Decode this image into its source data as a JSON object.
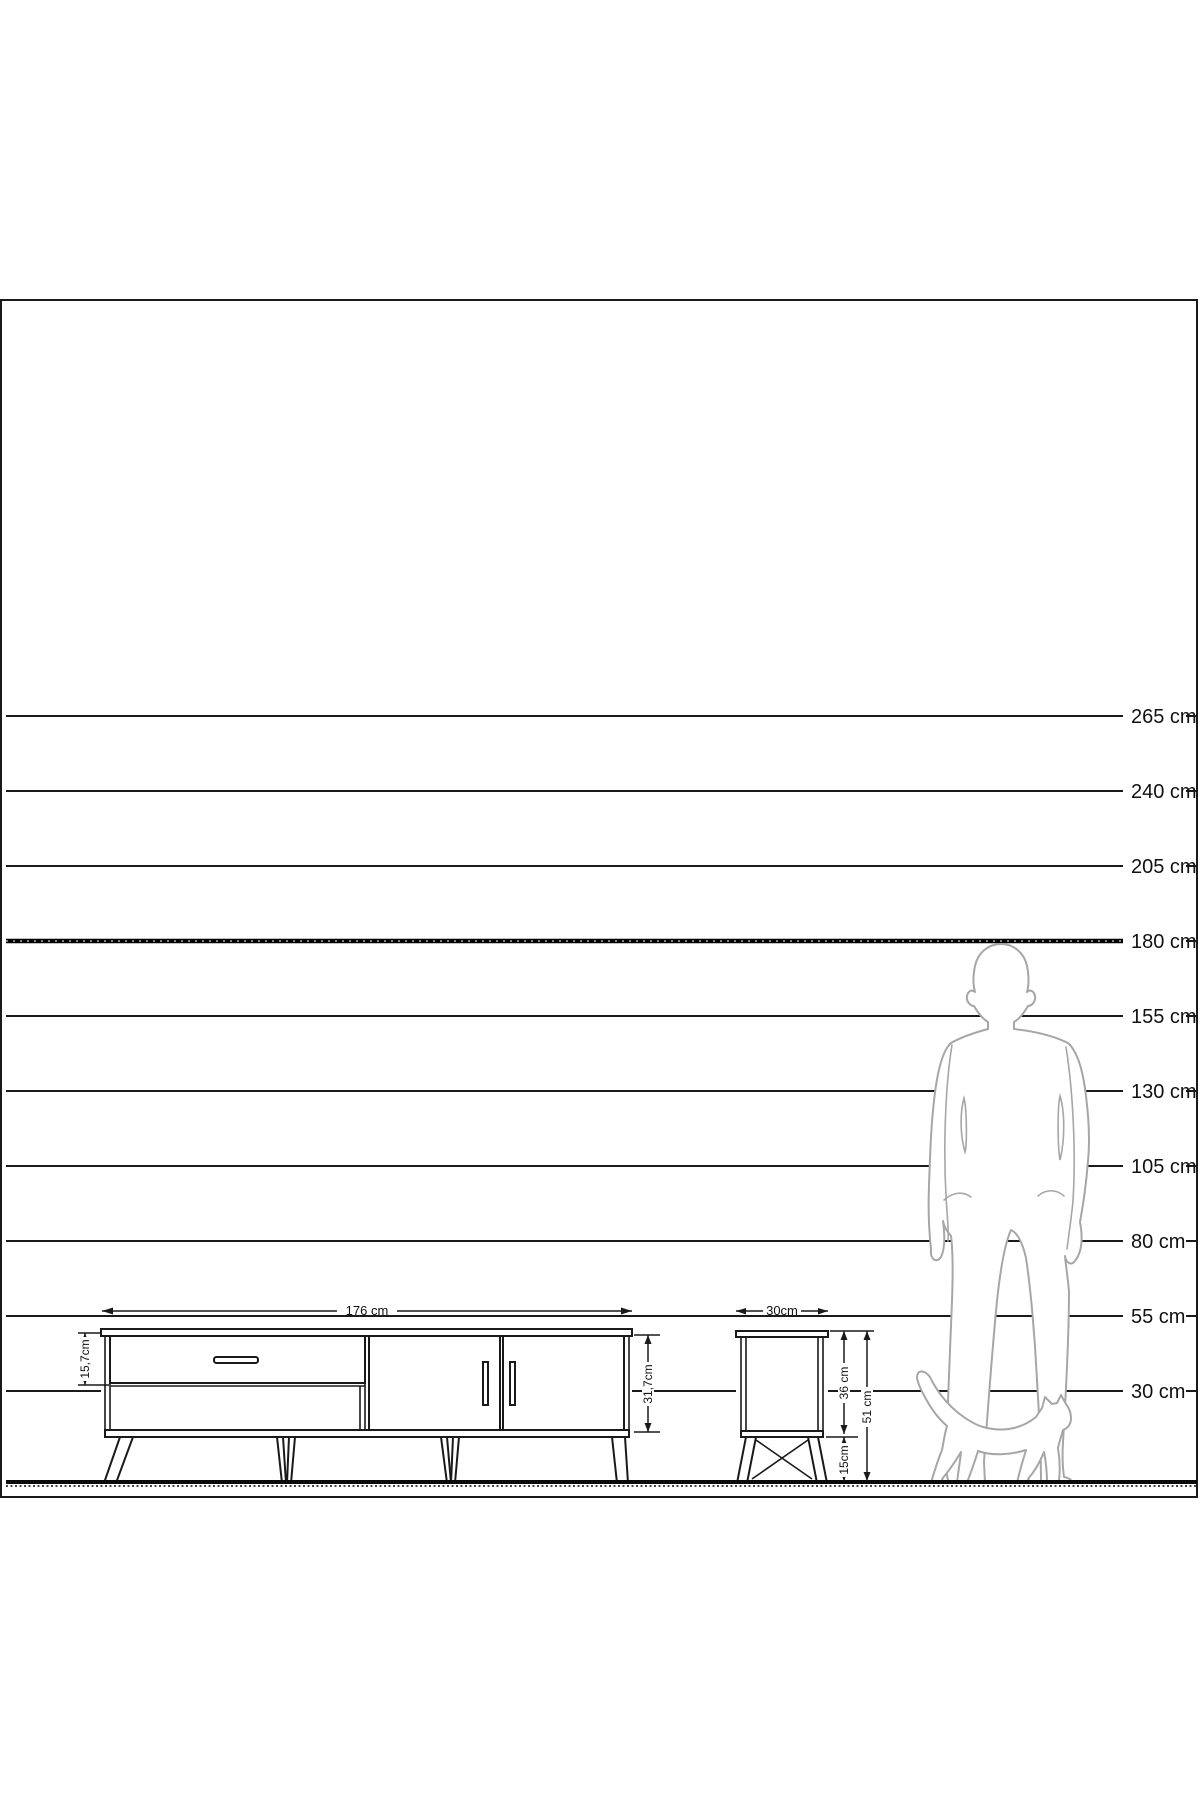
{
  "diagram": {
    "type": "furniture-scale-diagram",
    "colors": {
      "line": "#1a1a1a",
      "silhouette": "#a6a6a6",
      "background": "#ffffff"
    },
    "scale": {
      "unit": "cm",
      "rows": [
        {
          "label": "265 cm",
          "value": 265
        },
        {
          "label": "240 cm",
          "value": 240
        },
        {
          "label": "205 cm",
          "value": 205
        },
        {
          "label": "180 cm",
          "value": 180,
          "bold": true
        },
        {
          "label": "155 cm",
          "value": 155
        },
        {
          "label": "130 cm",
          "value": 130
        },
        {
          "label": "105 cm",
          "value": 105
        },
        {
          "label": "80 cm",
          "value": 80
        },
        {
          "label": "55 cm",
          "value": 55
        },
        {
          "label": "30 cm",
          "value": 30
        }
      ]
    },
    "items": [
      {
        "id": "tv-stand",
        "width_label": "176 cm",
        "drawer_height_label": "15,7cm",
        "carcass_height_label": "31,7cm"
      },
      {
        "id": "side-table",
        "width_label": "30cm",
        "carcass_height_label": "36 cm",
        "leg_height_label": "15cm",
        "total_height_label": "51 cm"
      }
    ],
    "figures": [
      {
        "id": "man-silhouette",
        "height_reference": "180 cm"
      },
      {
        "id": "cat-silhouette"
      }
    ]
  }
}
